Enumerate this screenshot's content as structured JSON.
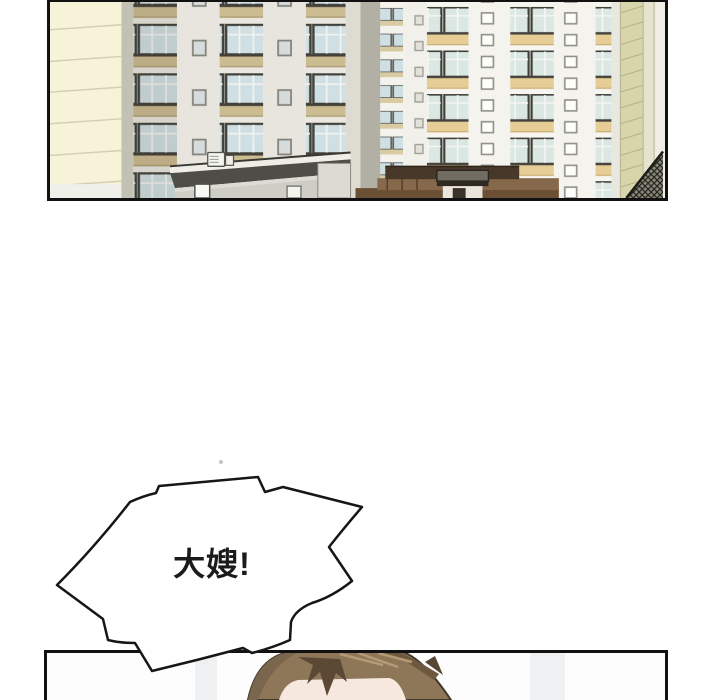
{
  "page": {
    "background_color": "#ffffff",
    "description": "vertical-scroll comic (webtoon) page section with two panels and one speech bubble"
  },
  "panels": {
    "apartments": {
      "alt": "Exterior establishing shot of high-rise apartment towers with balconies, a flat-roofed foreground building with AC unit, and brown entrance structures",
      "border_color": "#111111",
      "colors": {
        "cream_wall": "#f6f3d9",
        "tower_wall": "#e7e5dd",
        "tower_wall_bright": "#f4f3ed",
        "balcony_glass": "#cfdfe3",
        "spandrel_khaki": "#cbbc92",
        "spandrel_gold": "#e6cd96",
        "flat_roof_dark": "#4e4d48",
        "entrance_brown": "#7a5b3e",
        "side_wall_olive": "#d7d5aa",
        "hatched_roof_base": "#8a897d"
      }
    },
    "head_closeup": {
      "alt": "Close-up of the top of a person's head with brown hair, cropped by the panel border",
      "border_color": "#111111",
      "colors": {
        "hair_base": "#8d7758",
        "hair_shadow": "#5b4935",
        "hair_highlight": "#b59a75",
        "skin": "#f7e8df"
      }
    }
  },
  "speech_bubble": {
    "text": "大嫂!",
    "shape": "burst",
    "fill_color": "#ffffff",
    "outline_color": "#161616",
    "text_color": "#1b1b1b"
  }
}
